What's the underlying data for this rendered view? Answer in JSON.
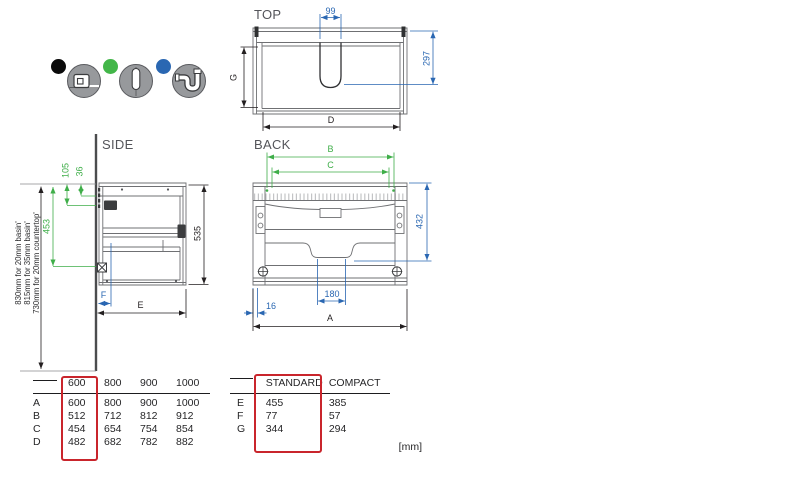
{
  "legend": {
    "items": [
      {
        "id": "basin-dimensions",
        "dot_color": "#0b0b0b",
        "icon": "tape-measure-icon"
      },
      {
        "id": "fixing-positions",
        "dot_color": "#43b649",
        "icon": "screw-icon"
      },
      {
        "id": "plumbing",
        "dot_color": "#2a67b2",
        "icon": "siphon-trap-icon"
      }
    ]
  },
  "views": {
    "top": {
      "title": "TOP",
      "dim_labels": {
        "cutout_width": "99",
        "depth_to_cutout": "297",
        "inner_depth": "G",
        "inner_width": "D"
      }
    },
    "side": {
      "title": "SIDE",
      "dim_labels": {
        "fixing_offset_small": "36",
        "fixing_offset_large": "105",
        "fixing_span": "453",
        "cabinet_height": "535",
        "cabinet_depth": "E",
        "siphon_offset": "F"
      },
      "install_heights": [
        "830mm for 20mm basin'",
        "815mm for 35mm basin'",
        "730mm for 20mm countertop'"
      ]
    },
    "back": {
      "title": "BACK",
      "dim_labels": {
        "fixing_width_b": "B",
        "fixing_width_c": "C",
        "height_to_notch": "432",
        "notch_width": "180",
        "side_clearance": "16",
        "cabinet_width": "A"
      }
    }
  },
  "tables": {
    "widths": {
      "headers": [
        "600",
        "800",
        "900",
        "1000"
      ],
      "highlighted": "600",
      "rows": [
        {
          "label": "A",
          "values": [
            "600",
            "800",
            "900",
            "1000"
          ]
        },
        {
          "label": "B",
          "values": [
            "512",
            "712",
            "812",
            "912"
          ]
        },
        {
          "label": "C",
          "values": [
            "454",
            "654",
            "754",
            "854"
          ]
        },
        {
          "label": "D",
          "values": [
            "482",
            "682",
            "782",
            "882"
          ]
        }
      ]
    },
    "depths": {
      "headers": [
        "STANDARD",
        "COMPACT"
      ],
      "highlighted": "STANDARD",
      "rows": [
        {
          "label": "E",
          "values": [
            "455",
            "385"
          ]
        },
        {
          "label": "F",
          "values": [
            "77",
            "57"
          ]
        },
        {
          "label": "G",
          "values": [
            "344",
            "294"
          ]
        }
      ]
    },
    "units": "[mm]"
  },
  "colors": {
    "dimension_black": "#231f20",
    "fixing_green": "#3fae49",
    "plumbing_blue": "#2a67b2",
    "highlight_red": "#c9252c",
    "drawing_gray": "#6f7073"
  }
}
